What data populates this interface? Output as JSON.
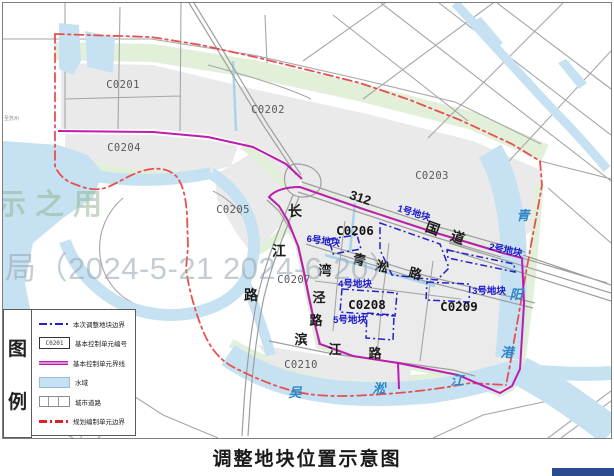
{
  "title": "调整地块位置示意图",
  "watermarks": {
    "stamp_left": "示之用",
    "date_note": "局（2024-5-21 2024-6-20）"
  },
  "map": {
    "unit_labels": [
      {
        "code": "C0201"
      },
      {
        "code": "C0202"
      },
      {
        "code": "C0203"
      },
      {
        "code": "C0204"
      },
      {
        "code": "C0205"
      },
      {
        "code": "C0206"
      },
      {
        "code": "C0207"
      },
      {
        "code": "C0208"
      },
      {
        "code": "C0209"
      },
      {
        "code": "C0210"
      }
    ],
    "plot_labels": [
      {
        "label": "1号地块"
      },
      {
        "label": "2号地块"
      },
      {
        "label": "3号地块"
      },
      {
        "label": "4号地块"
      },
      {
        "label": "5号地块"
      },
      {
        "label": "6号地块"
      }
    ],
    "road_labels": {
      "g312": "312",
      "guodao_1": "国",
      "guodao_2": "道",
      "qingsong_1": "青",
      "qingsong_2": "淞",
      "qingsong_3": "路",
      "changjiang_1": "长",
      "changjiang_2": "江",
      "changjiang_3": "路",
      "wanjing_1": "湾",
      "wanjing_2": "泾",
      "wanjing_3": "路",
      "binjiang_1": "滨",
      "binjiang_2": "江",
      "binjiang_3": "路",
      "to_suzhou": "至苏州"
    },
    "river_labels": {
      "qingyang_1": "青",
      "qingyang_2": "阳",
      "qingyang_3": "港",
      "wusong_1": "吴",
      "wusong_2": "淞",
      "wusong_3": "江"
    }
  },
  "legend": {
    "header_chars": [
      {
        "ch": "图"
      },
      {
        "ch": "例"
      }
    ],
    "items": [
      {
        "label": "本次调整地块边界"
      },
      {
        "label": "基本控制单元编号",
        "code": "C0201"
      },
      {
        "label": "基本控制单元界线"
      },
      {
        "label": "水域"
      },
      {
        "label": "城市道路"
      },
      {
        "label": "规划编制单元边界"
      }
    ]
  },
  "colors": {
    "water": "#C6E2F2",
    "green_space": "#E2F0DA",
    "unit_fill": "#EAEAEA",
    "road_gray": "#A6A6A6",
    "adjust_plot_blue": "#2222CC",
    "unit_boundary_magenta": "#BE1CAE",
    "planning_boundary_red": "#E34F4F",
    "river_label_blue": "#2E86C8",
    "corner_bar_blue": "#2A4B8F"
  }
}
